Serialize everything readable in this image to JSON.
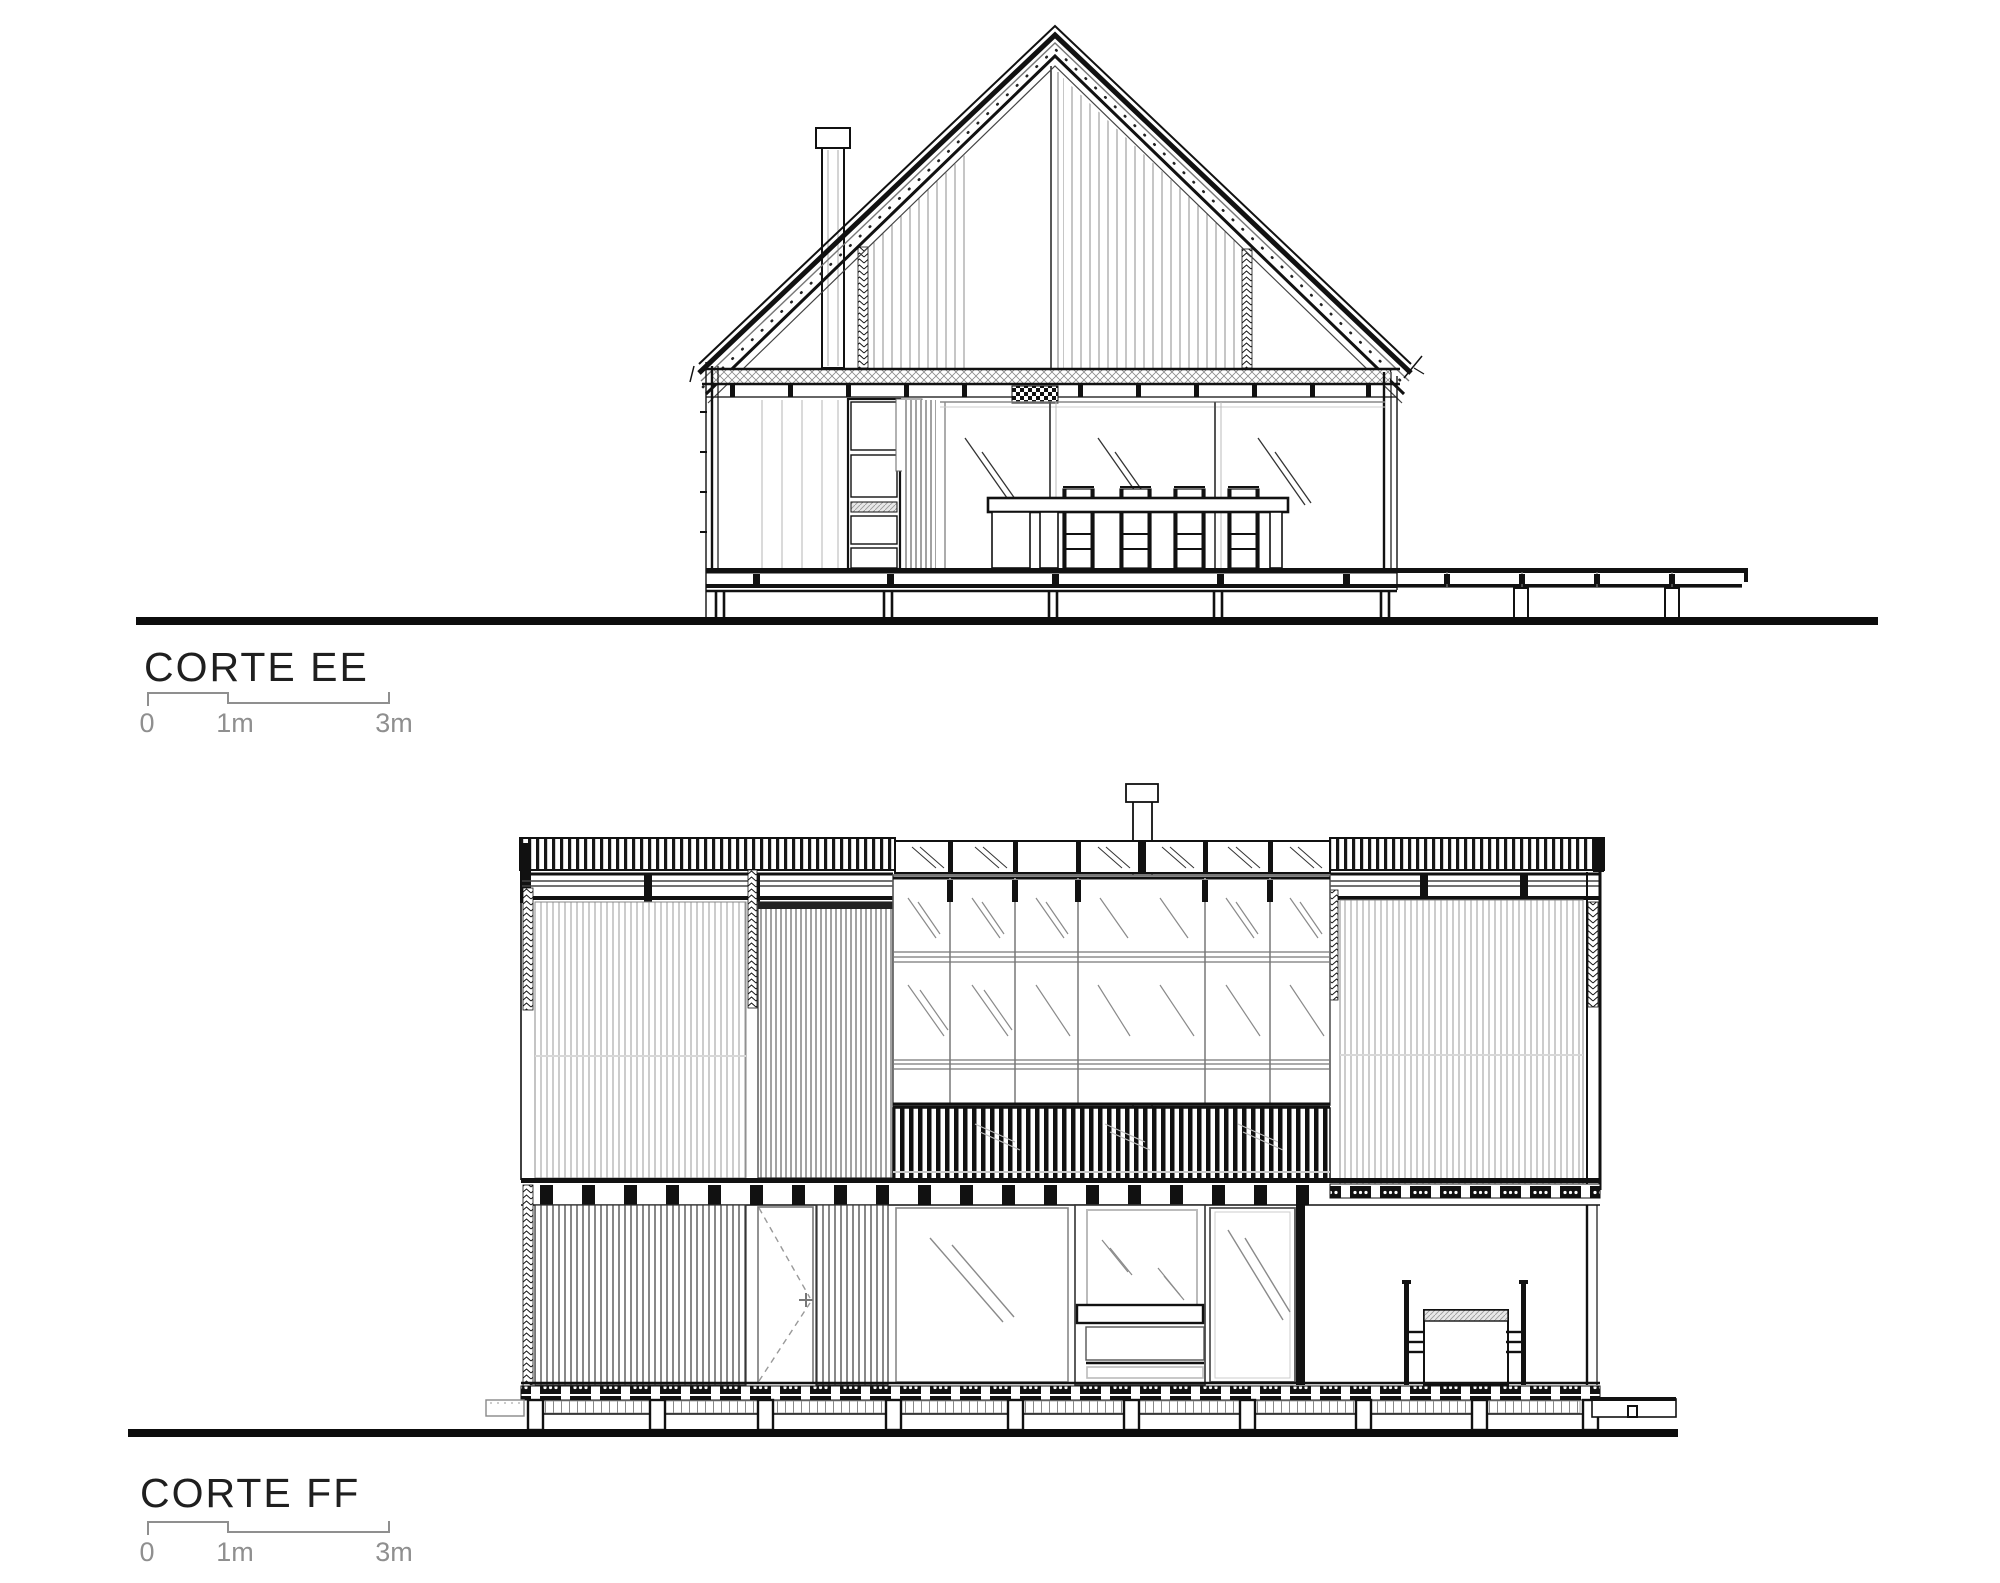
{
  "sections": {
    "ee": {
      "title": "CORTE EE",
      "scale_labels": [
        "0",
        "1m",
        "3m"
      ]
    },
    "ff": {
      "title": "CORTE FF",
      "scale_labels": [
        "0",
        "1m",
        "3m"
      ]
    }
  },
  "colors": {
    "ink": "#1a1a1a",
    "line_gray": "#8f8f8f",
    "light_gray": "#bbbbbb"
  }
}
